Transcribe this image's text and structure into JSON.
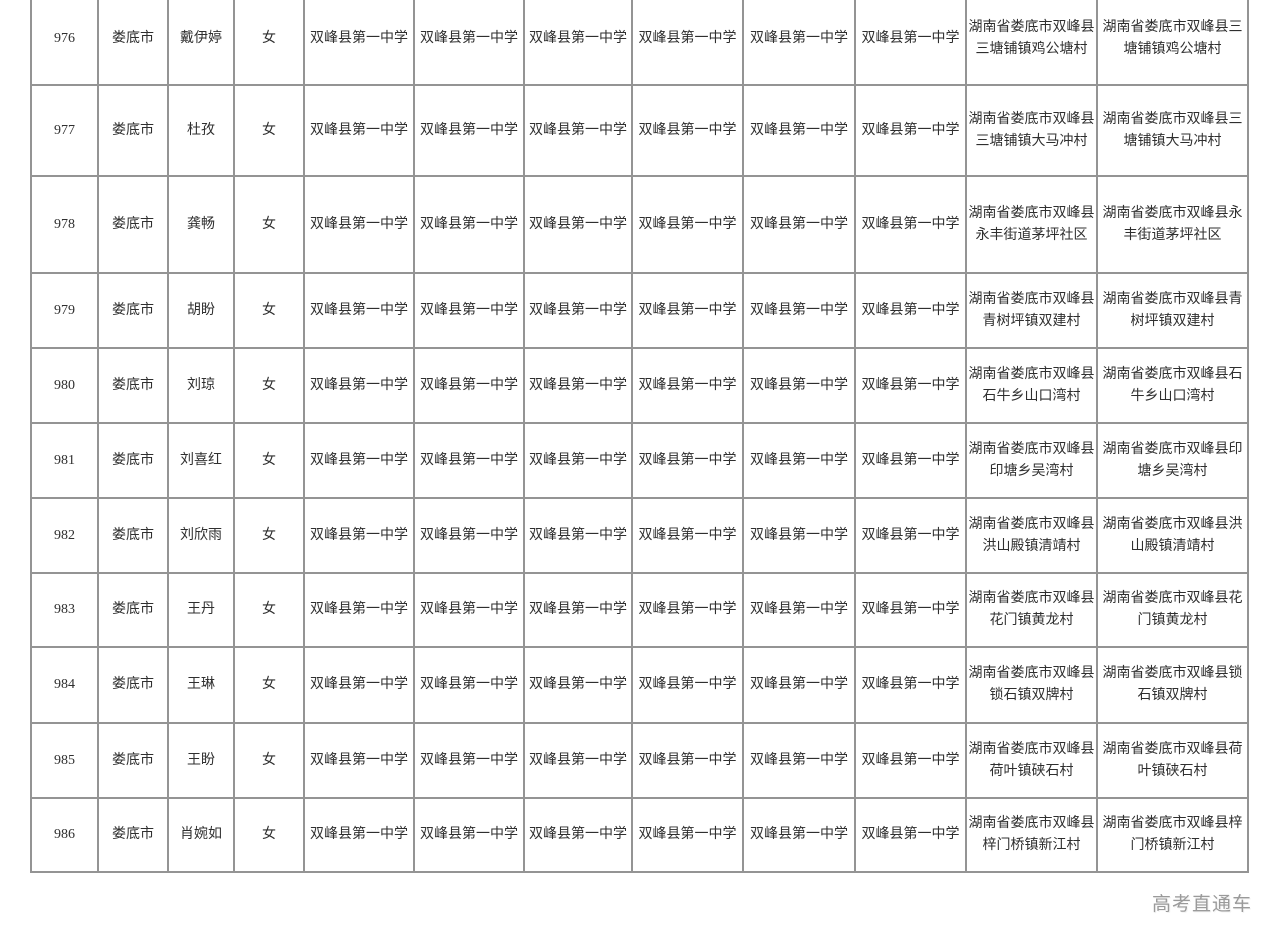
{
  "table": {
    "school_columns": 6,
    "rows": [
      {
        "no": "976",
        "city": "娄底市",
        "name": "戴伊婷",
        "gender": "女",
        "school": "双峰县第一中学",
        "address1": "湖南省娄底市双峰县三塘铺镇鸡公塘村",
        "address2": "湖南省娄底市双峰县三塘铺镇鸡公塘村"
      },
      {
        "no": "977",
        "city": "娄底市",
        "name": "杜孜",
        "gender": "女",
        "school": "双峰县第一中学",
        "address1": "湖南省娄底市双峰县三塘铺镇大马冲村",
        "address2": "湖南省娄底市双峰县三塘铺镇大马冲村"
      },
      {
        "no": "978",
        "city": "娄底市",
        "name": "龚畅",
        "gender": "女",
        "school": "双峰县第一中学",
        "address1": "湖南省娄底市双峰县永丰街道茅坪社区",
        "address2": "湖南省娄底市双峰县永丰街道茅坪社区"
      },
      {
        "no": "979",
        "city": "娄底市",
        "name": "胡盼",
        "gender": "女",
        "school": "双峰县第一中学",
        "address1": "湖南省娄底市双峰县青树坪镇双建村",
        "address2": "湖南省娄底市双峰县青树坪镇双建村"
      },
      {
        "no": "980",
        "city": "娄底市",
        "name": "刘琼",
        "gender": "女",
        "school": "双峰县第一中学",
        "address1": "湖南省娄底市双峰县石牛乡山口湾村",
        "address2": "湖南省娄底市双峰县石牛乡山口湾村"
      },
      {
        "no": "981",
        "city": "娄底市",
        "name": "刘喜红",
        "gender": "女",
        "school": "双峰县第一中学",
        "address1": "湖南省娄底市双峰县印塘乡吴湾村",
        "address2": "湖南省娄底市双峰县印塘乡吴湾村"
      },
      {
        "no": "982",
        "city": "娄底市",
        "name": "刘欣雨",
        "gender": "女",
        "school": "双峰县第一中学",
        "address1": "湖南省娄底市双峰县洪山殿镇清靖村",
        "address2": "湖南省娄底市双峰县洪山殿镇清靖村"
      },
      {
        "no": "983",
        "city": "娄底市",
        "name": "王丹",
        "gender": "女",
        "school": "双峰县第一中学",
        "address1": "湖南省娄底市双峰县花门镇黄龙村",
        "address2": "湖南省娄底市双峰县花门镇黄龙村"
      },
      {
        "no": "984",
        "city": "娄底市",
        "name": "王琳",
        "gender": "女",
        "school": "双峰县第一中学",
        "address1": "湖南省娄底市双峰县锁石镇双牌村",
        "address2": "湖南省娄底市双峰县锁石镇双牌村"
      },
      {
        "no": "985",
        "city": "娄底市",
        "name": "王盼",
        "gender": "女",
        "school": "双峰县第一中学",
        "address1": "湖南省娄底市双峰县荷叶镇硖石村",
        "address2": "湖南省娄底市双峰县荷叶镇硖石村"
      },
      {
        "no": "986",
        "city": "娄底市",
        "name": "肖婉如",
        "gender": "女",
        "school": "双峰县第一中学",
        "address1": "湖南省娄底市双峰县梓门桥镇新江村",
        "address2": "湖南省娄底市双峰县梓门桥镇新江村"
      }
    ]
  },
  "watermark": "高考直通车",
  "colors": {
    "border": "#949494",
    "text": "#2f2f2f",
    "watermark": "#9a9a9a"
  }
}
